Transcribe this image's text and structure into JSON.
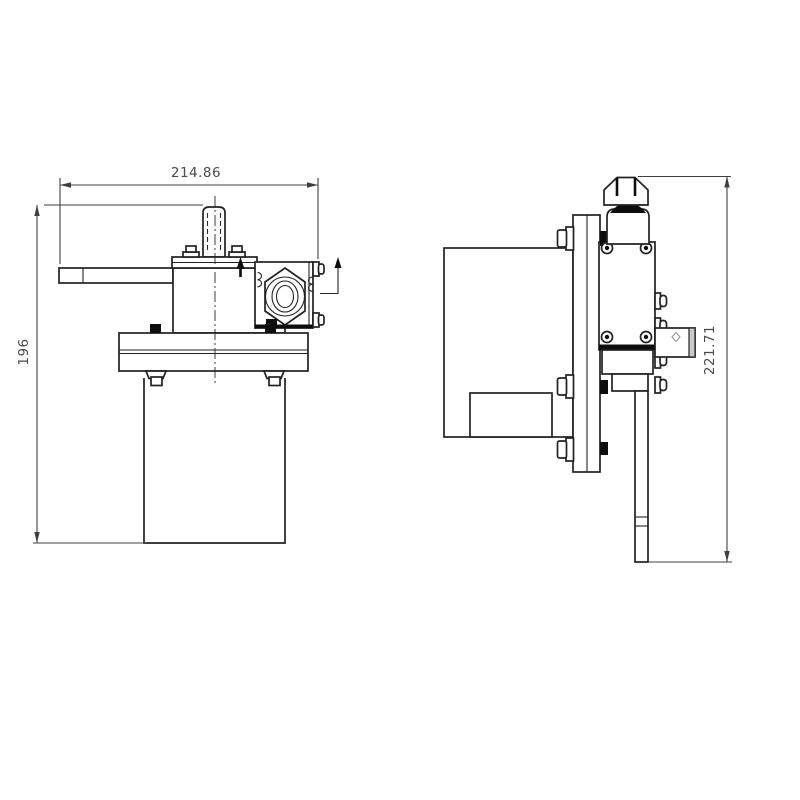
{
  "page": {
    "background": "#ffffff"
  },
  "drawing": {
    "type": "orthographic-engineering-drawing",
    "view_count": 2,
    "views": [
      {
        "id": "front-view",
        "dimensions": [
          "214.86",
          "196"
        ]
      },
      {
        "id": "side-view",
        "dimensions": [
          "221.71"
        ]
      }
    ],
    "colors": {
      "outline": "#222222",
      "dark_fill": "#0d0d0d",
      "dim_line": "#3f3f3f",
      "dim_text": "#4a4a4a",
      "background": "#ffffff"
    }
  },
  "labels": {
    "front_width": "214.86",
    "front_height": "196",
    "side_height": "221.71"
  }
}
